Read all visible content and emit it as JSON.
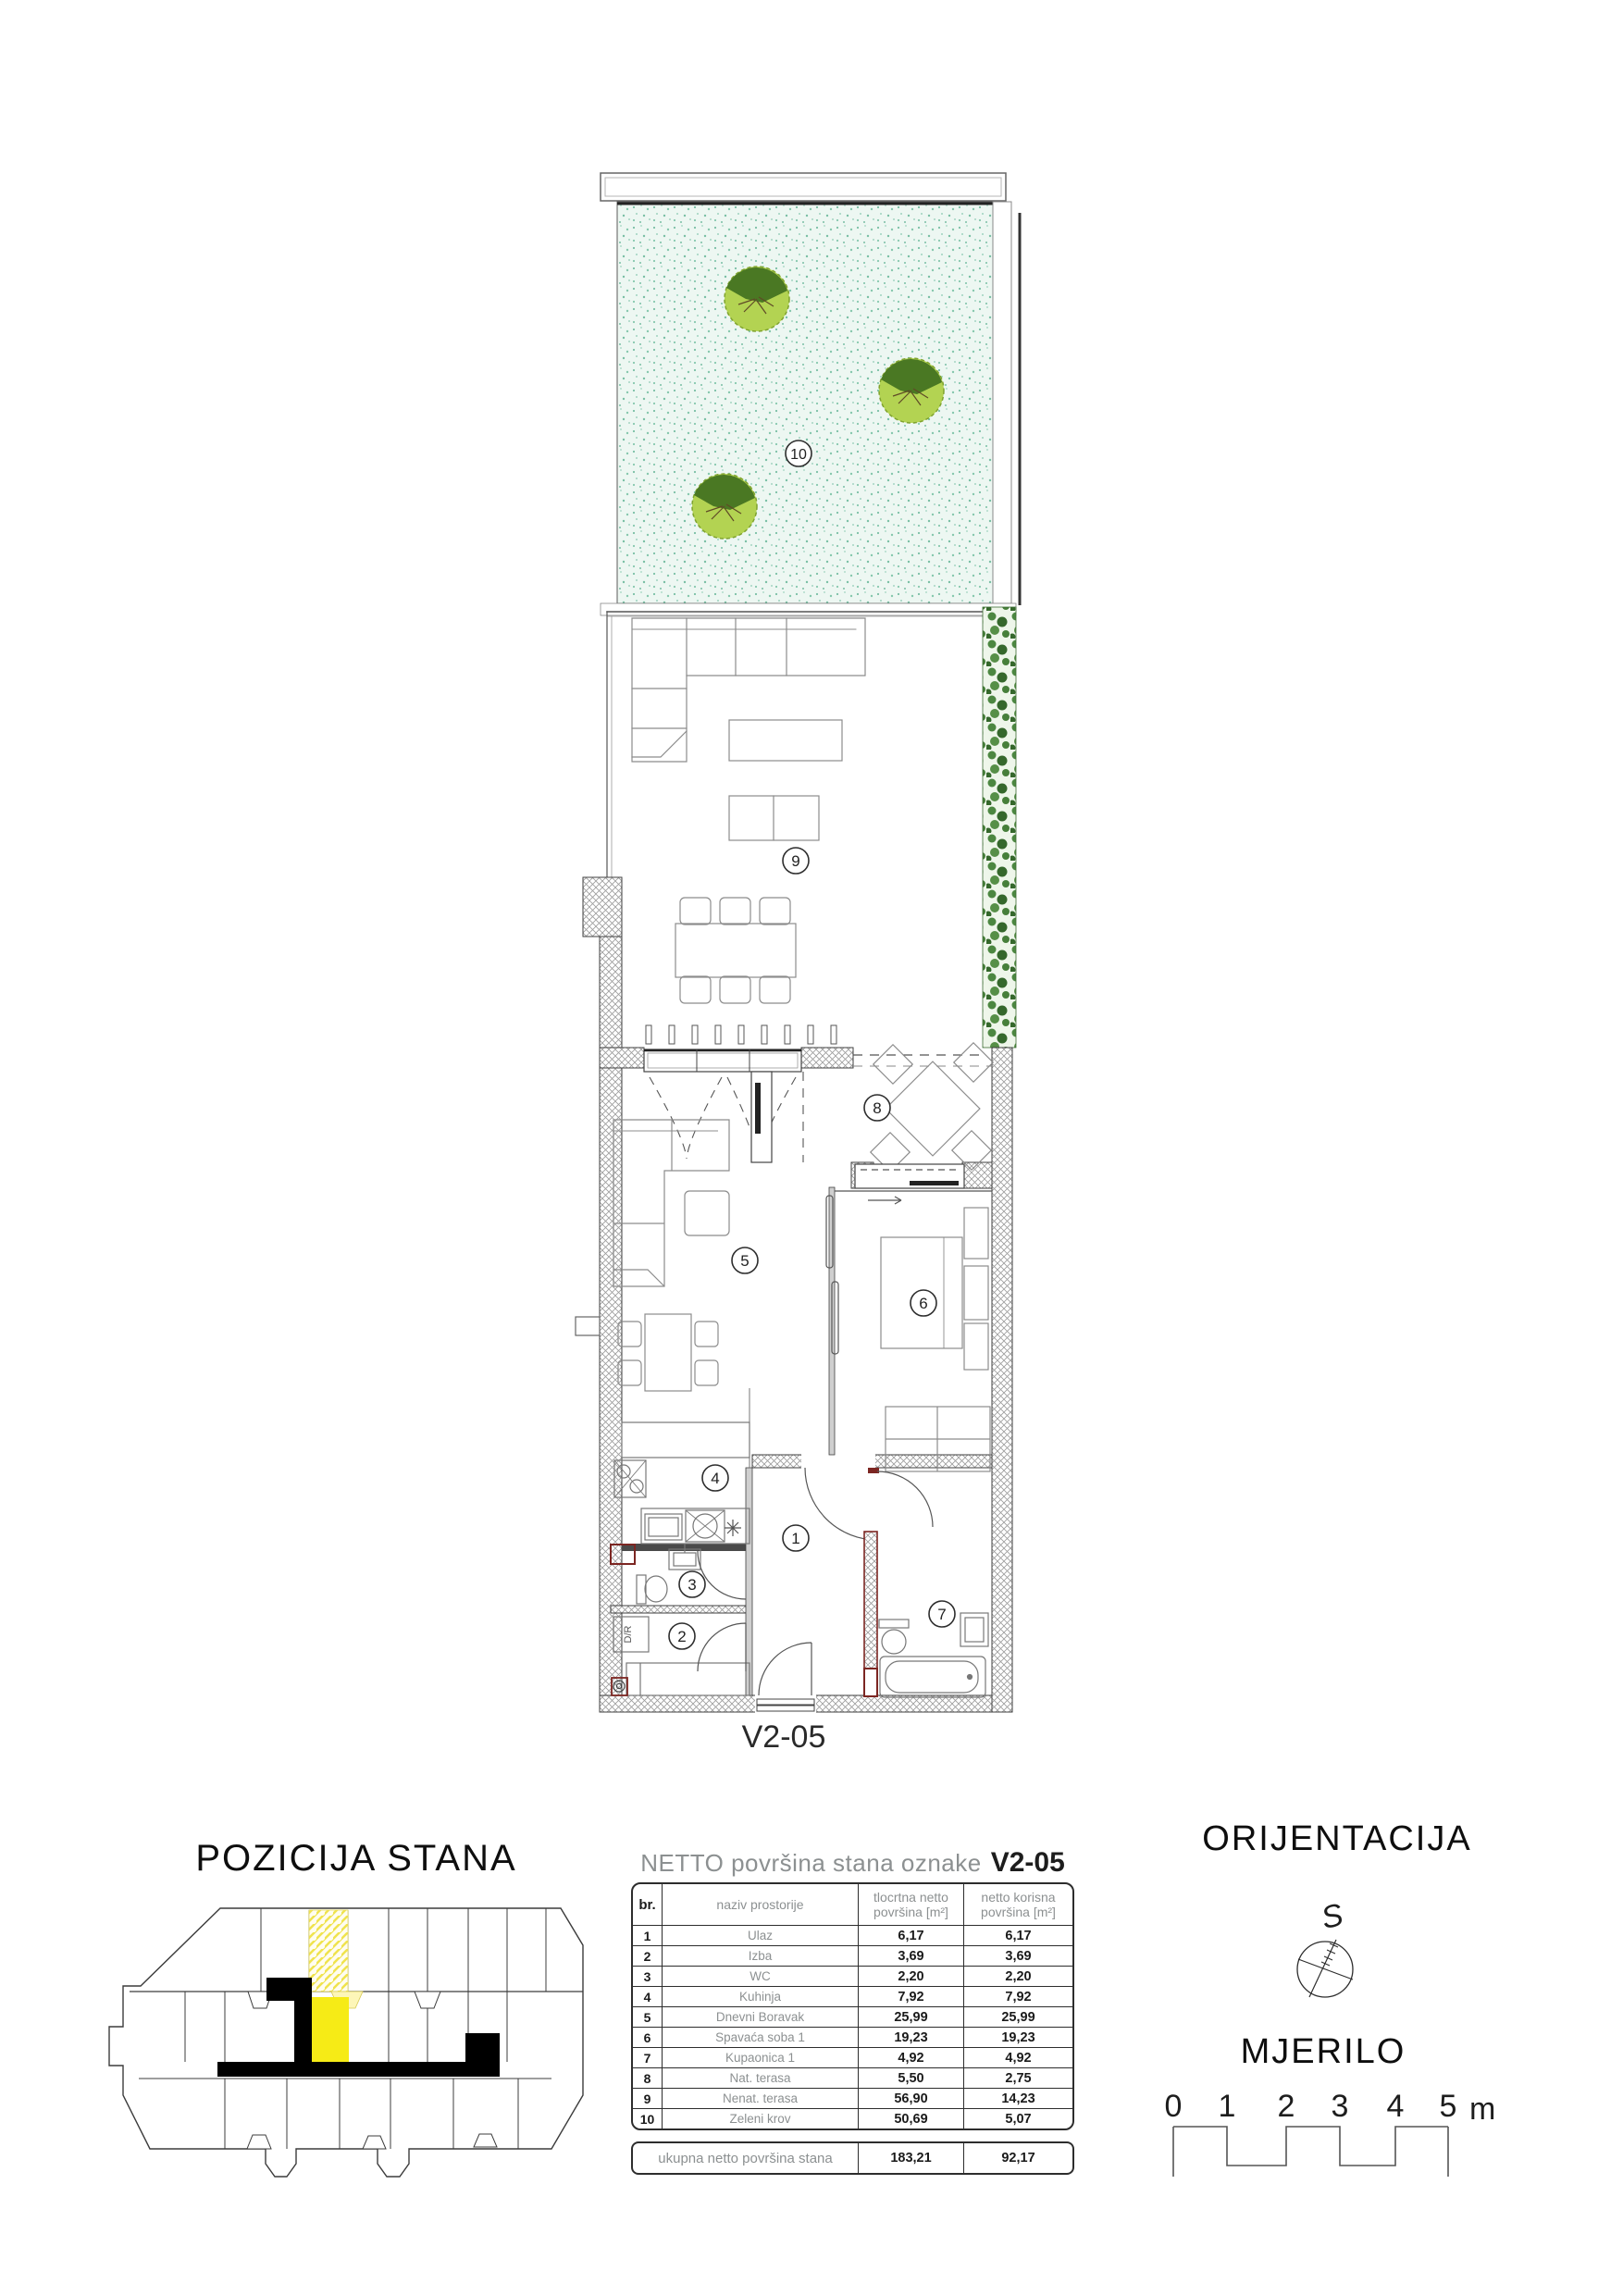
{
  "plan": {
    "unit_label": "V2-05",
    "room_labels": [
      "1",
      "2",
      "3",
      "4",
      "5",
      "6",
      "7",
      "8",
      "9",
      "10"
    ],
    "appliance_label": "D/R"
  },
  "pozicija": {
    "title": "POZICIJA STANA",
    "highlight_color": "#f6eb16"
  },
  "table": {
    "title_prefix": "NETTO površina stana oznake",
    "unit": "V2-05",
    "headers": {
      "br": "br.",
      "name": "naziv prostorije",
      "col1_line1": "tlocrtna netto",
      "col1_line2": "površina [m²]",
      "col2_line1": "netto korisna",
      "col2_line2": "površina [m²]"
    },
    "rows": [
      {
        "br": "1",
        "name": "Ulaz",
        "v1": "6,17",
        "v2": "6,17"
      },
      {
        "br": "2",
        "name": "Izba",
        "v1": "3,69",
        "v2": "3,69"
      },
      {
        "br": "3",
        "name": "WC",
        "v1": "2,20",
        "v2": "2,20"
      },
      {
        "br": "4",
        "name": "Kuhinja",
        "v1": "7,92",
        "v2": "7,92"
      },
      {
        "br": "5",
        "name": "Dnevni Boravak",
        "v1": "25,99",
        "v2": "25,99"
      },
      {
        "br": "6",
        "name": "Spavaća soba 1",
        "v1": "19,23",
        "v2": "19,23"
      },
      {
        "br": "7",
        "name": "Kupaonica 1",
        "v1": "4,92",
        "v2": "4,92"
      },
      {
        "br": "8",
        "name": "Nat. terasa",
        "v1": "5,50",
        "v2": "2,75"
      },
      {
        "br": "9",
        "name": "Nenat. terasa",
        "v1": "56,90",
        "v2": "14,23"
      },
      {
        "br": "10",
        "name": "Zeleni krov",
        "v1": "50,69",
        "v2": "5,07"
      }
    ],
    "total": {
      "label": "ukupna netto površina stana",
      "v1": "183,21",
      "v2": "92,17"
    }
  },
  "orijentacija": {
    "title": "ORIJENTACIJA",
    "south_label": "S"
  },
  "mjerilo": {
    "title": "MJERILO",
    "ticks": [
      "0",
      "1",
      "2",
      "3",
      "4",
      "5"
    ],
    "unit_label": "m"
  }
}
